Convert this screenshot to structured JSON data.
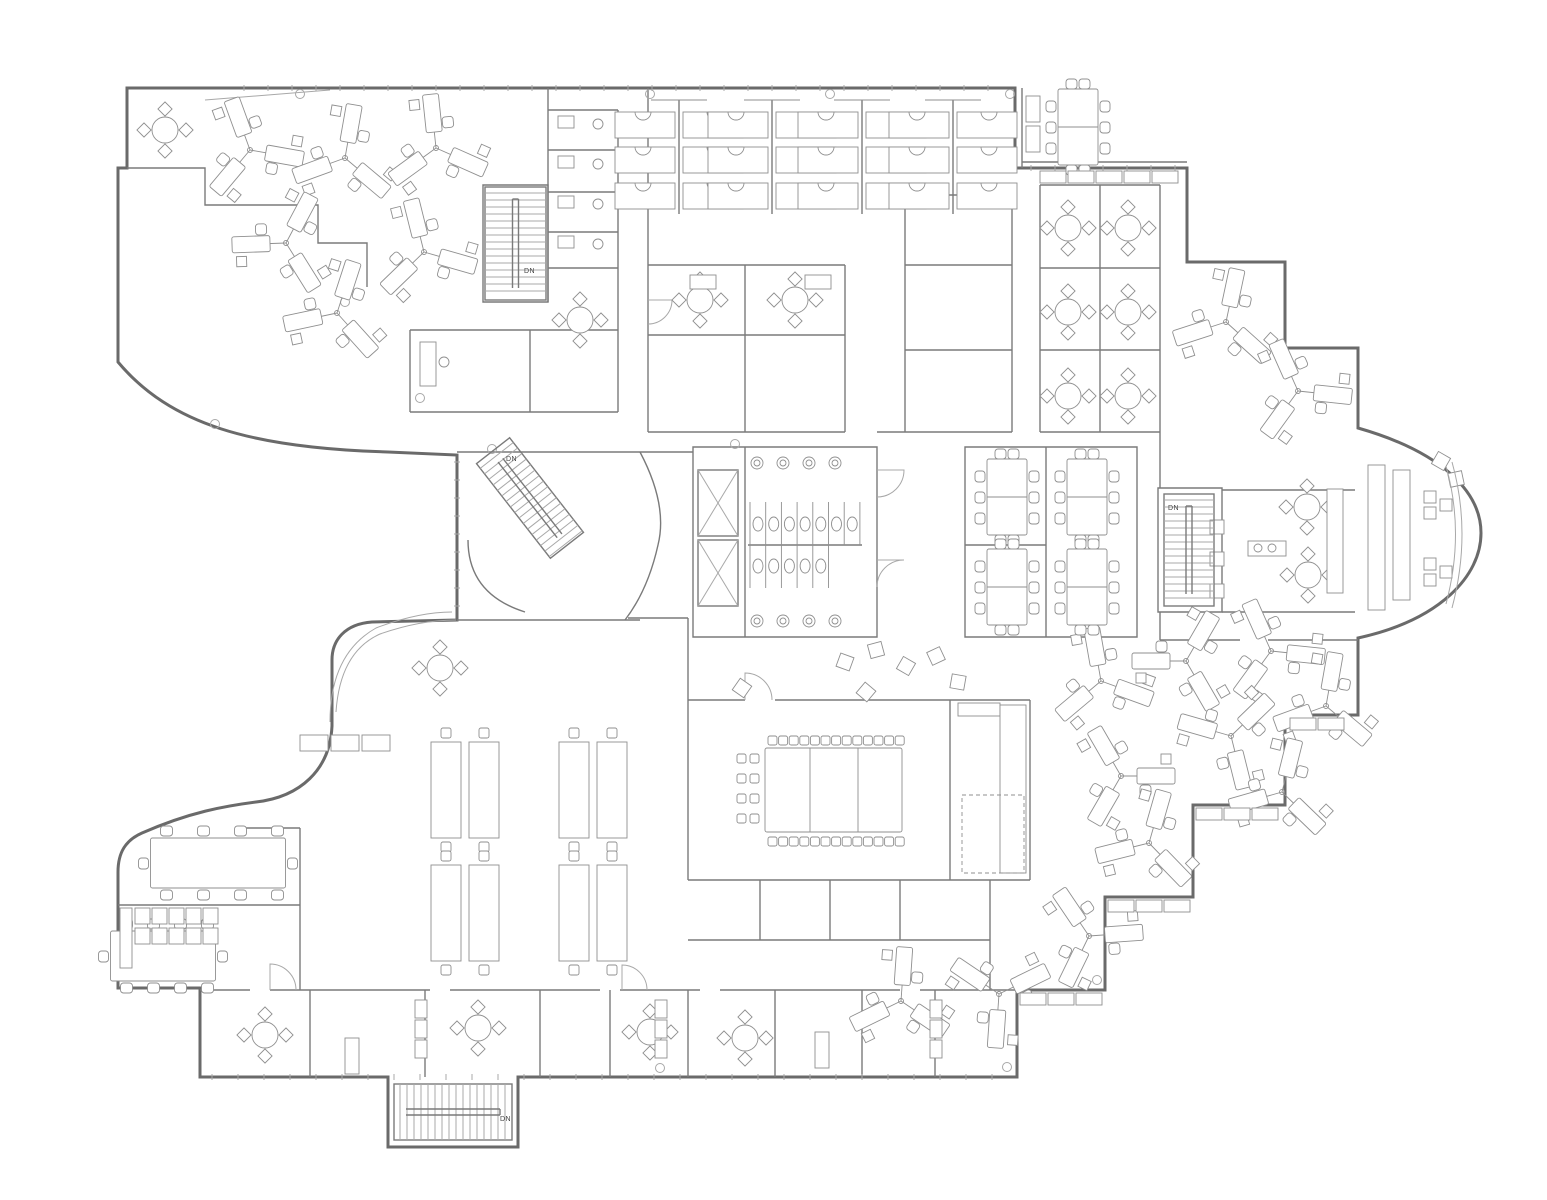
{
  "plan": {
    "kind": "office-floor-plan",
    "stair_direction_label": "DN"
  },
  "colors": {
    "background": "#ffffff",
    "exterior_wall": "#6a6a6a",
    "interior_wall": "#7a7a7a",
    "light_line": "#a8a8a8",
    "furniture": "#8f8f8f",
    "label": "#444444"
  },
  "stairs": [
    {
      "name": "northwest-stair",
      "label": "DN"
    },
    {
      "name": "atrium-stair",
      "label": "DN"
    },
    {
      "name": "east-stair",
      "label": "DN"
    },
    {
      "name": "south-stair",
      "label": "DN"
    }
  ],
  "legend_symbols": [
    "pinwheel-workstation-cluster",
    "bench-workstation-column",
    "round-table-4-chairs",
    "meeting-table-8-chairs",
    "boardroom-table",
    "stair",
    "elevator",
    "toilet-stall",
    "sink",
    "lounge-seat",
    "cabinet-run",
    "desk-pair-station",
    "bay-lounge"
  ],
  "furniture": {
    "pinwheel_clusters": [
      {
        "x": 250,
        "y": 150,
        "r": -20
      },
      {
        "x": 345,
        "y": 158,
        "r": 10
      },
      {
        "x": 436,
        "y": 148,
        "r": -6
      },
      {
        "x": 286,
        "y": 243,
        "r": 28
      },
      {
        "x": 424,
        "y": 252,
        "r": -14
      },
      {
        "x": 337,
        "y": 313,
        "r": 18
      },
      {
        "x": 1226,
        "y": 322,
        "r": 12
      },
      {
        "x": 1298,
        "y": 391,
        "r": -24
      },
      {
        "x": 1101,
        "y": 681,
        "r": -10
      },
      {
        "x": 1186,
        "y": 661,
        "r": 30
      },
      {
        "x": 1271,
        "y": 651,
        "r": -24
      },
      {
        "x": 1326,
        "y": 706,
        "r": 10
      },
      {
        "x": 1231,
        "y": 736,
        "r": 46
      },
      {
        "x": 1121,
        "y": 776,
        "r": -30
      },
      {
        "x": 1282,
        "y": 792,
        "r": 14
      },
      {
        "x": 901,
        "y": 1001,
        "r": 4
      },
      {
        "x": 999,
        "y": 994,
        "r": 184
      },
      {
        "x": 1089,
        "y": 936,
        "r": -34
      },
      {
        "x": 1149,
        "y": 843,
        "r": 16
      }
    ],
    "bench_columns": [
      {
        "x": 679
      },
      {
        "x": 772
      },
      {
        "x": 862
      },
      {
        "x": 953
      }
    ],
    "round_tables": [
      {
        "x": 165,
        "y": 130
      },
      {
        "x": 1068,
        "y": 228
      },
      {
        "x": 1128,
        "y": 228
      },
      {
        "x": 1068,
        "y": 312
      },
      {
        "x": 1128,
        "y": 312
      },
      {
        "x": 1068,
        "y": 396
      },
      {
        "x": 1128,
        "y": 396
      },
      {
        "x": 1307,
        "y": 507
      },
      {
        "x": 1308,
        "y": 575
      },
      {
        "x": 265,
        "y": 1035
      },
      {
        "x": 478,
        "y": 1028
      },
      {
        "x": 650,
        "y": 1032
      },
      {
        "x": 745,
        "y": 1038
      },
      {
        "x": 440,
        "y": 668
      },
      {
        "x": 580,
        "y": 320
      },
      {
        "x": 700,
        "y": 300
      },
      {
        "x": 795,
        "y": 300
      }
    ],
    "meeting_tables_8": [
      {
        "x": 1078,
        "y": 127
      },
      {
        "x": 1007,
        "y": 497
      },
      {
        "x": 1087,
        "y": 497
      },
      {
        "x": 1007,
        "y": 587
      },
      {
        "x": 1087,
        "y": 587
      }
    ],
    "conference_tables_10": [
      {
        "x": 218,
        "y": 863,
        "w": 135,
        "h": 50
      },
      {
        "x": 163,
        "y": 956,
        "w": 105,
        "h": 50
      }
    ],
    "big_conference": {
      "x": 832,
      "y": 790,
      "chairs_top": 13,
      "chairs_bottom": 13,
      "chairs_side": 8
    },
    "lounge_seats": [
      {
        "x": 845,
        "y": 662,
        "r": 20
      },
      {
        "x": 876,
        "y": 650,
        "r": -15
      },
      {
        "x": 906,
        "y": 666,
        "r": 30
      },
      {
        "x": 936,
        "y": 656,
        "r": -25
      },
      {
        "x": 958,
        "y": 682,
        "r": 10
      },
      {
        "x": 866,
        "y": 692,
        "r": 40
      },
      {
        "x": 1441,
        "y": 461,
        "r": 30
      },
      {
        "x": 1456,
        "y": 479,
        "r": -12
      },
      {
        "x": 742,
        "y": 688,
        "r": 35
      }
    ],
    "bay_seat_groups": [
      {
        "x": 1430,
        "y": 505
      },
      {
        "x": 1430,
        "y": 572
      }
    ],
    "desk_pair_stations": [
      {
        "x": 465,
        "y": 790
      },
      {
        "x": 593,
        "y": 790
      },
      {
        "x": 465,
        "y": 913
      },
      {
        "x": 593,
        "y": 913
      }
    ]
  }
}
